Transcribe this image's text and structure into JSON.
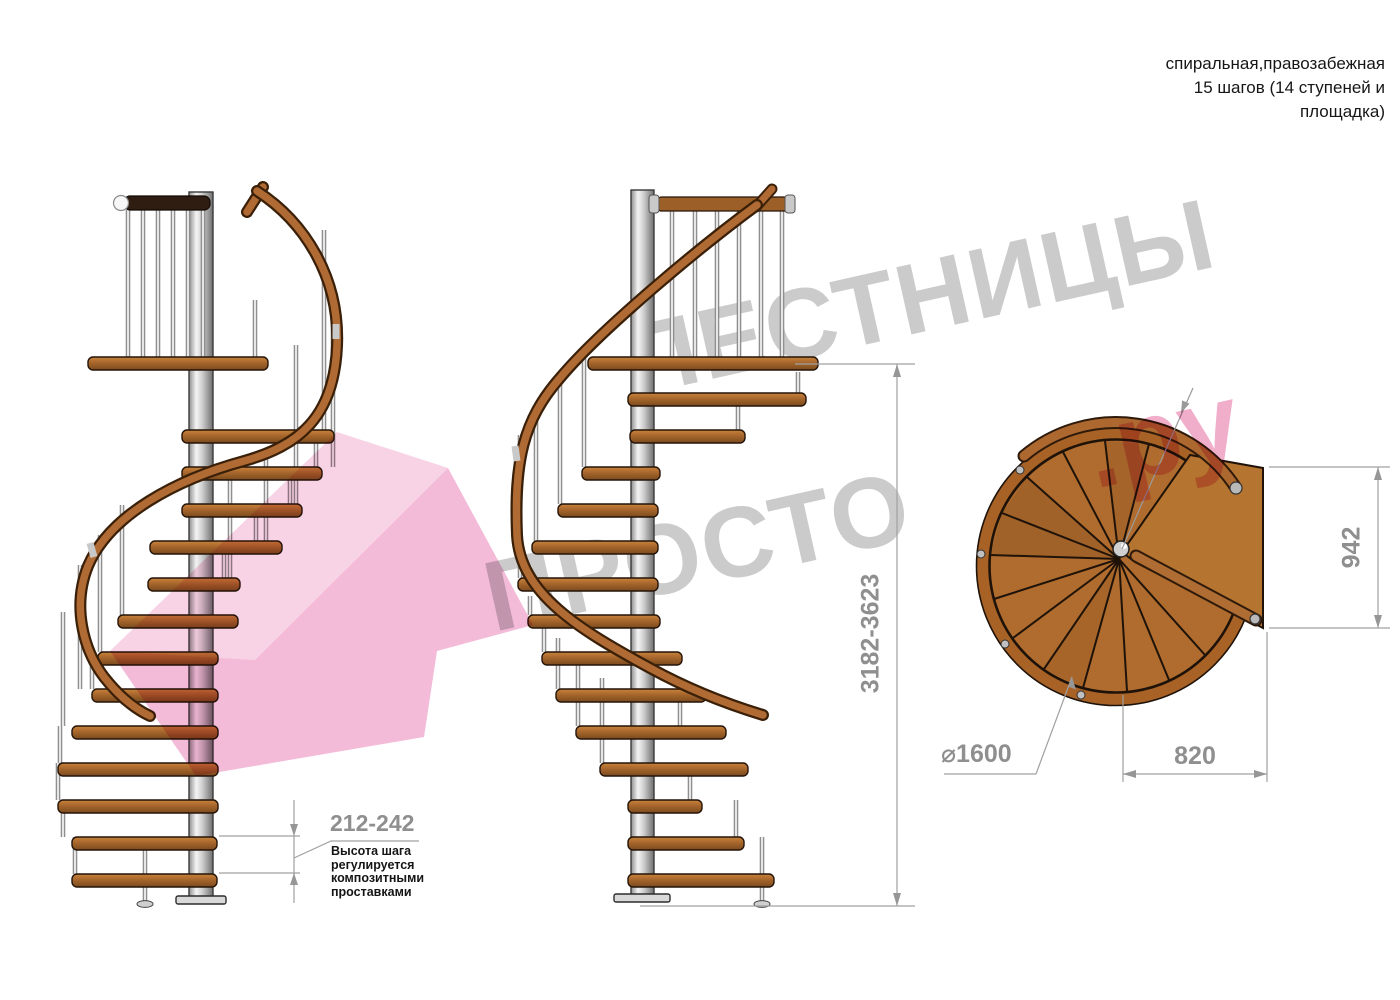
{
  "title": {
    "line1": "спиральная,правозабежная",
    "line2": "15 шагов (14 ступеней и",
    "line3": "площадка)"
  },
  "dimensions": {
    "total_height_range": "3182-3623",
    "step_height_range": "212-242",
    "plan_depth": "942",
    "landing_width": "820",
    "diameter": "⌀1600"
  },
  "step_note": {
    "line1": "Высота шага",
    "line2": "регулируется",
    "line3": "композитными",
    "line4": "проставками"
  },
  "watermark": {
    "word1": "ЛЕСТНИЦЫ",
    "word2": "ПРОСТО",
    "word3": ".ру"
  },
  "colors": {
    "wood": "#a9682e",
    "wood_dark": "#7c4a1e",
    "handrail": "#ad6830",
    "metal_pole": "#d9d9d9",
    "dimension_gray": "#8f8f8f",
    "watermark_gray": "#cbcbcb",
    "watermark_pink": "#f1aecb",
    "text_black": "#161616"
  }
}
